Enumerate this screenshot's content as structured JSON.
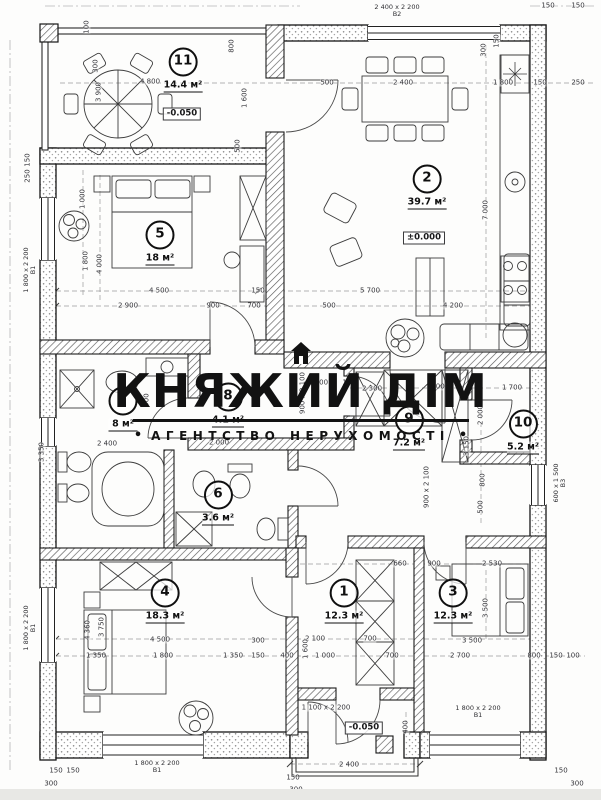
{
  "watermark": {
    "title": "КНЯЖИЙ ДІМ",
    "subtitle": "АГЕНТСТВО НЕРУХОМОСТІ",
    "bullet": "•"
  },
  "colors": {
    "ink": "#1a1a1a",
    "dim_text": "#35353a",
    "watermark": "#121212",
    "paper": "#ffffff"
  },
  "plan": {
    "rooms": [
      {
        "num": "1",
        "area": "12.3 м²",
        "x": 344,
        "y": 601
      },
      {
        "num": "2",
        "area": "39.7 м²",
        "x": 427,
        "y": 187
      },
      {
        "num": "3",
        "area": "12.3 м²",
        "x": 453,
        "y": 601
      },
      {
        "num": "4",
        "area": "18.3 м²",
        "x": 165,
        "y": 601
      },
      {
        "num": "5",
        "area": "18 м²",
        "x": 160,
        "y": 243
      },
      {
        "num": "6",
        "area": "3.6 м²",
        "x": 218,
        "y": 503
      },
      {
        "num": "7",
        "area": "8 м²",
        "x": 123,
        "y": 409
      },
      {
        "num": "8",
        "area": "4.1 м²",
        "x": 228,
        "y": 405
      },
      {
        "num": "9",
        "area": "7.2 м²",
        "x": 409,
        "y": 428
      },
      {
        "num": "10",
        "area": "5.2 м²",
        "x": 523,
        "y": 432
      },
      {
        "num": "11",
        "area": "14.4 м²",
        "x": 183,
        "y": 70
      }
    ],
    "elevations": [
      {
        "t": "-0.050",
        "x": 182,
        "y": 114
      },
      {
        "t": "±0.000",
        "x": 424,
        "y": 238
      },
      {
        "t": "-0.050",
        "x": 364,
        "y": 728
      }
    ],
    "windows": [
      {
        "t": "2 400 х 2 200",
        "sub": "В2",
        "x": 397,
        "y": 11,
        "v": 0
      },
      {
        "t": "1 800 х 2 200",
        "sub": "В1",
        "x": 30,
        "y": 270,
        "v": 1
      },
      {
        "t": "1 800 х 2 200",
        "sub": "В1",
        "x": 30,
        "y": 628,
        "v": 1
      },
      {
        "t": "1 800 х 2 200",
        "sub": "В1",
        "x": 157,
        "y": 767,
        "v": 0
      },
      {
        "t": "1 800 х 2 200",
        "sub": "В1",
        "x": 478,
        "y": 712,
        "v": 0
      },
      {
        "t": "600 х 1 500",
        "sub": "В3",
        "x": 560,
        "y": 483,
        "v": 1
      }
    ],
    "dimensions": [
      {
        "t": "4 800",
        "x": 150,
        "y": 82
      },
      {
        "t": "3 900",
        "x": 99,
        "y": 92,
        "v": 1
      },
      {
        "t": "100",
        "x": 87,
        "y": 27,
        "v": 1
      },
      {
        "t": "300",
        "x": 96,
        "y": 66,
        "v": 1
      },
      {
        "t": "800",
        "x": 232,
        "y": 46,
        "v": 1
      },
      {
        "t": "1 600",
        "x": 245,
        "y": 98,
        "v": 1
      },
      {
        "t": "500",
        "x": 238,
        "y": 146,
        "v": 1
      },
      {
        "t": "500",
        "x": 327,
        "y": 83
      },
      {
        "t": "2 400",
        "x": 403,
        "y": 83
      },
      {
        "t": "1 800",
        "x": 503,
        "y": 83
      },
      {
        "t": "150",
        "x": 540,
        "y": 83
      },
      {
        "t": "250",
        "x": 578,
        "y": 83
      },
      {
        "t": "150",
        "x": 548,
        "y": 6
      },
      {
        "t": "150",
        "x": 578,
        "y": 6
      },
      {
        "t": "300",
        "x": 484,
        "y": 50,
        "v": 1
      },
      {
        "t": "150",
        "x": 497,
        "y": 41,
        "v": 1
      },
      {
        "t": "7 000",
        "x": 486,
        "y": 210,
        "v": 1
      },
      {
        "t": "150",
        "x": 28,
        "y": 160,
        "v": 1
      },
      {
        "t": "250",
        "x": 28,
        "y": 176,
        "v": 1
      },
      {
        "t": "4 500",
        "x": 159,
        "y": 291
      },
      {
        "t": "150",
        "x": 258,
        "y": 291
      },
      {
        "t": "5 700",
        "x": 370,
        "y": 291
      },
      {
        "t": "2 900",
        "x": 128,
        "y": 306
      },
      {
        "t": "900",
        "x": 213,
        "y": 306
      },
      {
        "t": "700",
        "x": 254,
        "y": 306
      },
      {
        "t": "500",
        "x": 329,
        "y": 306
      },
      {
        "t": "4 200",
        "x": 453,
        "y": 306
      },
      {
        "t": "1 000",
        "x": 83,
        "y": 199,
        "v": 1
      },
      {
        "t": "1 800",
        "x": 86,
        "y": 261,
        "v": 1
      },
      {
        "t": "4 000",
        "x": 100,
        "y": 264,
        "v": 1
      },
      {
        "t": "3 350",
        "x": 42,
        "y": 452,
        "v": 1
      },
      {
        "t": "900",
        "x": 147,
        "y": 400,
        "v": 1
      },
      {
        "t": "2 400",
        "x": 107,
        "y": 444
      },
      {
        "t": "1 500",
        "x": 318,
        "y": 383
      },
      {
        "t": "100",
        "x": 349,
        "y": 383
      },
      {
        "t": "2 300",
        "x": 372,
        "y": 389
      },
      {
        "t": "100",
        "x": 438,
        "y": 387
      },
      {
        "t": "1 700",
        "x": 512,
        "y": 388
      },
      {
        "t": "2 000",
        "x": 481,
        "y": 415,
        "v": 1
      },
      {
        "t": "3 150",
        "x": 467,
        "y": 446,
        "v": 1
      },
      {
        "t": "800",
        "x": 483,
        "y": 480,
        "v": 1
      },
      {
        "t": "500",
        "x": 481,
        "y": 507,
        "v": 1
      },
      {
        "t": "2 000",
        "x": 219,
        "y": 443
      },
      {
        "t": "900 х 2 100",
        "x": 303,
        "y": 393,
        "v": 1
      },
      {
        "t": "900 х 2 100",
        "x": 427,
        "y": 487,
        "v": 1
      },
      {
        "t": "660",
        "x": 400,
        "y": 564
      },
      {
        "t": "900",
        "x": 434,
        "y": 564
      },
      {
        "t": "2 530",
        "x": 492,
        "y": 564
      },
      {
        "t": "3 500",
        "x": 486,
        "y": 608,
        "v": 1
      },
      {
        "t": "3 500",
        "x": 472,
        "y": 641
      },
      {
        "t": "2 700",
        "x": 460,
        "y": 656
      },
      {
        "t": "800",
        "x": 534,
        "y": 656
      },
      {
        "t": "150",
        "x": 556,
        "y": 656
      },
      {
        "t": "100",
        "x": 573,
        "y": 656
      },
      {
        "t": "4 500",
        "x": 160,
        "y": 640
      },
      {
        "t": "3 750",
        "x": 102,
        "y": 627,
        "v": 1
      },
      {
        "t": "4 360",
        "x": 88,
        "y": 630,
        "v": 1
      },
      {
        "t": "300",
        "x": 258,
        "y": 641
      },
      {
        "t": "1 350",
        "x": 96,
        "y": 656
      },
      {
        "t": "1 800",
        "x": 163,
        "y": 656
      },
      {
        "t": "1 350",
        "x": 233,
        "y": 656
      },
      {
        "t": "150",
        "x": 258,
        "y": 656
      },
      {
        "t": "400",
        "x": 287,
        "y": 656
      },
      {
        "t": "2 100",
        "x": 315,
        "y": 639
      },
      {
        "t": "700",
        "x": 370,
        "y": 639
      },
      {
        "t": "1 000",
        "x": 325,
        "y": 656
      },
      {
        "t": "700",
        "x": 392,
        "y": 656
      },
      {
        "t": "1 600",
        "x": 306,
        "y": 649,
        "v": 1
      },
      {
        "t": "1 100 х 2 200",
        "x": 326,
        "y": 708
      },
      {
        "t": "2 400",
        "x": 349,
        "y": 765
      },
      {
        "t": "400",
        "x": 406,
        "y": 727,
        "v": 1
      },
      {
        "t": "150",
        "x": 293,
        "y": 778
      },
      {
        "t": "300",
        "x": 296,
        "y": 790
      },
      {
        "t": "1 450",
        "x": 82,
        "y": 793
      },
      {
        "t": "1 500",
        "x": 169,
        "y": 793
      },
      {
        "t": "1 650",
        "x": 238,
        "y": 793
      },
      {
        "t": "150",
        "x": 56,
        "y": 771
      },
      {
        "t": "150",
        "x": 73,
        "y": 771
      },
      {
        "t": "300",
        "x": 51,
        "y": 784
      },
      {
        "t": "150",
        "x": 561,
        "y": 771
      },
      {
        "t": "300",
        "x": 577,
        "y": 784
      }
    ]
  }
}
